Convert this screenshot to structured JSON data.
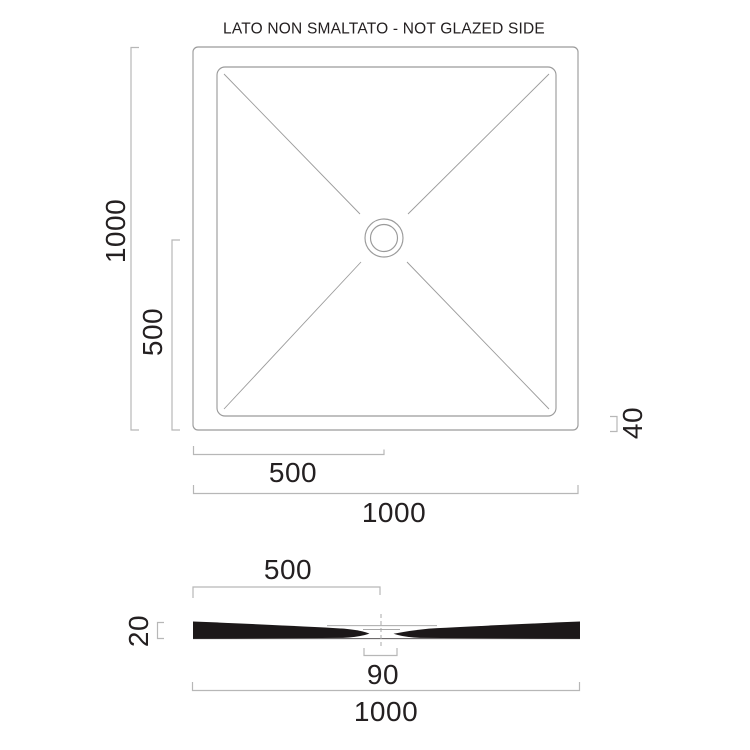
{
  "title": "LATO NON SMALTATO - NOT GLAZED SIDE",
  "plan_view": {
    "dim_height_total": "1000",
    "dim_height_half": "500",
    "dim_width_half": "500",
    "dim_width_total": "1000",
    "dim_edge_height": "40"
  },
  "section_view": {
    "dim_width_half": "500",
    "dim_thickness": "20",
    "dim_drain_width": "90",
    "dim_width_total": "1000"
  },
  "colors": {
    "background": "#ffffff",
    "line": "#9b9b9b",
    "dim_line": "#b7b7b7",
    "text": "#242021",
    "section_fill": "#1c1819"
  }
}
